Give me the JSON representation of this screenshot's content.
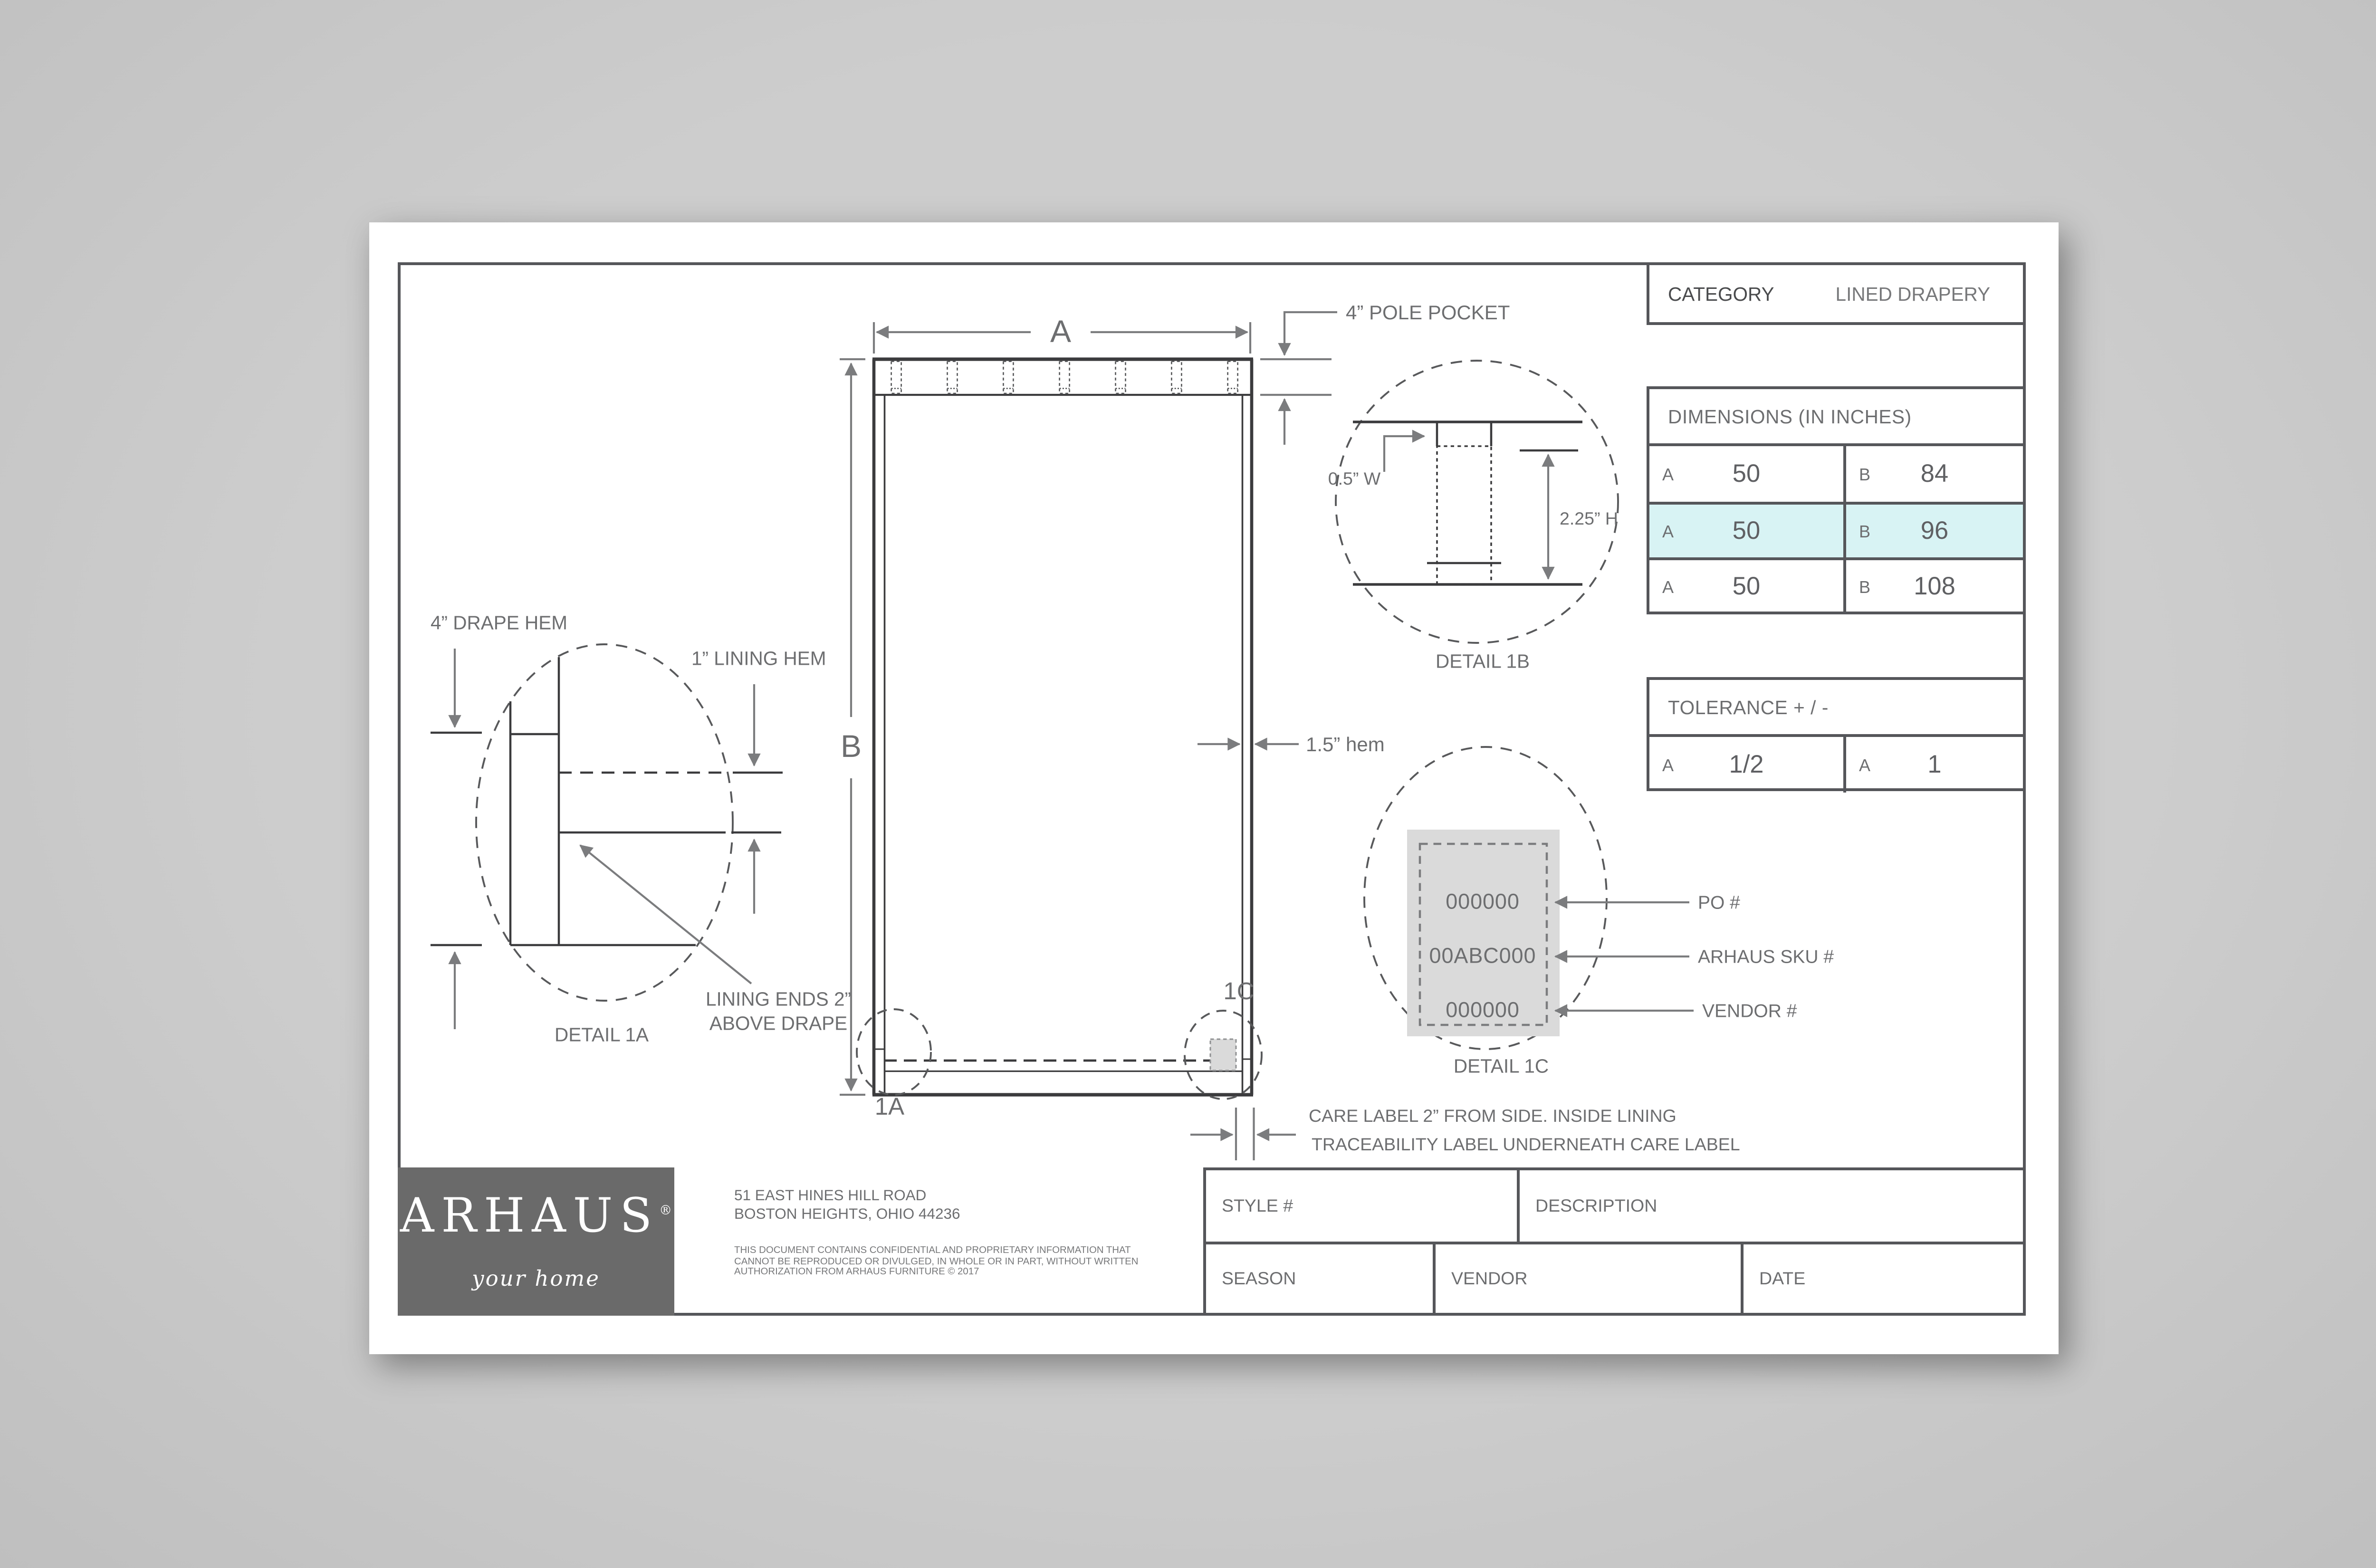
{
  "colors": {
    "background": "#c9c9c9",
    "sheet": "#ffffff",
    "line_dark": "#3b3b3d",
    "line_gray": "#7b7c7e",
    "border": "#55565a",
    "highlight_row": "#d8f3f4",
    "logo_block": "#6a6a6a",
    "label_fill": "#dadada"
  },
  "category": {
    "label": "CATEGORY",
    "value": "LINED DRAPERY"
  },
  "dimensions_table": {
    "title": "DIMENSIONS (IN INCHES)",
    "rows": [
      {
        "a_label": "A",
        "a": "50",
        "b_label": "B",
        "b": "84"
      },
      {
        "a_label": "A",
        "a": "50",
        "b_label": "B",
        "b": "96"
      },
      {
        "a_label": "A",
        "a": "50",
        "b_label": "B",
        "b": "108"
      }
    ]
  },
  "tolerance_table": {
    "title": "TOLERANCE + / -",
    "row": {
      "a_label": "A",
      "a": "1/2",
      "b_label": "A",
      "b": "1"
    }
  },
  "drawing": {
    "dim_a": "A",
    "dim_b": "B",
    "pole_pocket_label": "4” POLE POCKET",
    "side_hem_label": "1.5” hem",
    "ref_1a": "1A",
    "ref_1c": "1C",
    "care_note_line1": "CARE LABEL 2” FROM SIDE. INSIDE LINING",
    "care_note_line2": "TRACEABILITY LABEL UNDERNEATH CARE LABEL"
  },
  "detail_1a": {
    "title": "DETAIL 1A",
    "drape_hem_label": "4” DRAPE HEM",
    "lining_hem_label": "1” LINING HEM",
    "note_line1": "LINING ENDS 2”",
    "note_line2": "ABOVE DRAPE"
  },
  "detail_1b": {
    "title": "DETAIL 1B",
    "width_label": "0.5” W",
    "height_label": "2.25” H"
  },
  "detail_1c": {
    "title": "DETAIL 1C",
    "po_value": "000000",
    "sku_value": "00ABC000",
    "vendor_value": "000000",
    "po_label": "PO #",
    "sku_label": "ARHAUS SKU #",
    "vendor_label": "VENDOR #"
  },
  "title_block": {
    "logo_word": "ARHAUS",
    "logo_reg": "®",
    "logo_tagline": "your home",
    "address_line1": "51 EAST HINES HILL ROAD",
    "address_line2": "BOSTON HEIGHTS, OHIO 44236",
    "legal_line1": "THIS DOCUMENT CONTAINS CONFIDENTIAL AND PROPRIETARY INFORMATION THAT",
    "legal_line2": "CANNOT BE REPRODUCED OR DIVULGED, IN WHOLE OR IN PART, WITHOUT WRITTEN",
    "legal_line3": "AUTHORIZATION FROM ARHAUS FURNITURE © 2017",
    "style_label": "STYLE #",
    "description_label": "DESCRIPTION",
    "season_label": "SEASON",
    "vendor_label": "VENDOR",
    "date_label": "DATE"
  }
}
